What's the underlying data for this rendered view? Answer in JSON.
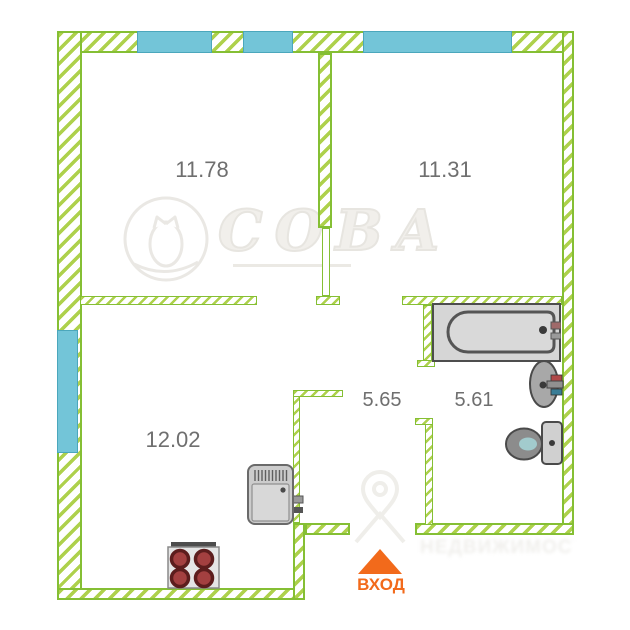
{
  "floorplan": {
    "rooms": [
      {
        "name": "room-top-left",
        "area_label": "11.78"
      },
      {
        "name": "room-top-right",
        "area_label": "11.31"
      },
      {
        "name": "kitchen",
        "area_label": "12.02"
      },
      {
        "name": "hallway",
        "area_label": "5.65"
      },
      {
        "name": "bathroom",
        "area_label": "5.61"
      }
    ],
    "entrance": {
      "label": "ВХОД",
      "icon": "entrance-arrow-up-icon"
    },
    "fixtures": [
      "bathtub-icon",
      "sink-icon",
      "toilet-icon",
      "stove-icon",
      "refrigerator-icon"
    ],
    "watermarks": {
      "center": {
        "icon": "owl-logo-icon",
        "text": "СОВА"
      },
      "bottom_right": {
        "icon": "map-pin-icon",
        "text": "НЕДВИЖИМОСТЬ"
      }
    },
    "colors": {
      "wall_hatch_green": "#aed14c",
      "wall_border_green": "#85bf34",
      "window_fill": "#73c5d8",
      "window_border": "#4ba7bc",
      "entrance_orange": "#f26a1b",
      "room_label_grey": "#6f6f6f",
      "fixture_grey": "#8a8a8a"
    }
  }
}
